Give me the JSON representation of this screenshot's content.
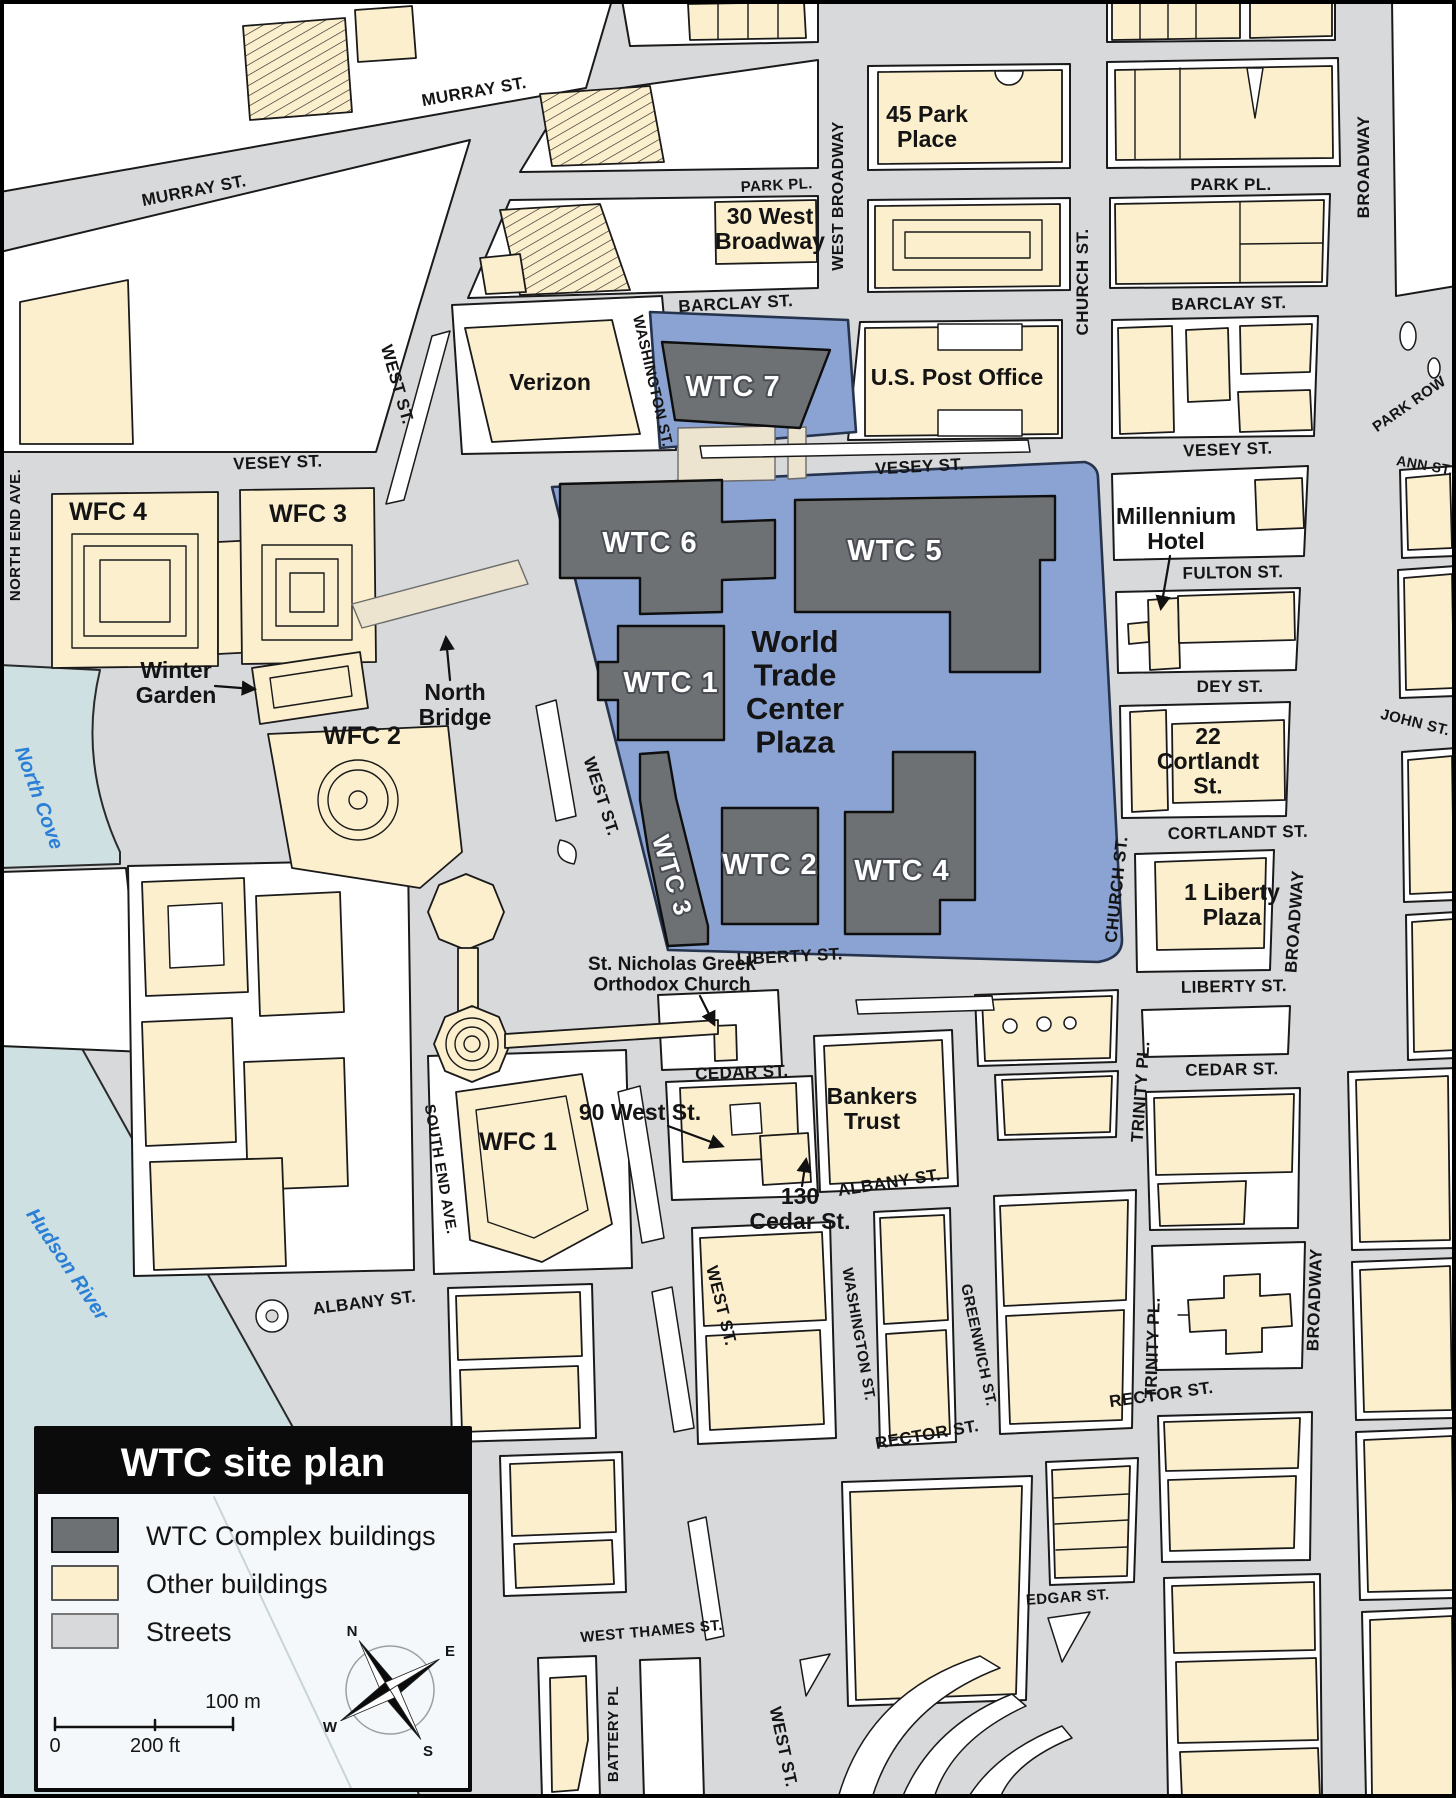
{
  "page_title": "WTC site plan",
  "colors": {
    "wtc": "#6e7173",
    "other": "#fcefcd",
    "street": "#d8d9db",
    "plaza": "#8ba3d2",
    "water": "#cfe0e3",
    "outline": "#1a1a1a"
  },
  "legend": {
    "title": "WTC site plan",
    "items": [
      {
        "label": "WTC Complex buildings",
        "color_key": "wtc"
      },
      {
        "label": "Other buildings",
        "color_key": "other"
      },
      {
        "label": "Streets",
        "color_key": "street"
      }
    ]
  },
  "scale_bar": {
    "m_label": "100 m",
    "zero_label": "0",
    "ft_label": "200 ft"
  },
  "compass": {
    "n": "N",
    "e": "E",
    "s": "S",
    "w": "W"
  },
  "water_labels": [
    {
      "text": "North Cove",
      "x": 33,
      "y": 800,
      "rot": 70,
      "cls": "wat",
      "name": "north-cove-label"
    },
    {
      "text": "Hudson River",
      "x": 62,
      "y": 1268,
      "rot": 56,
      "cls": "wat",
      "name": "hudson-river-label"
    }
  ],
  "street_labels": [
    {
      "text": "MURRAY ST.",
      "x": 475,
      "y": 97,
      "rot": -10
    },
    {
      "text": "MURRAY ST.",
      "x": 195,
      "y": 196,
      "rot": -11
    },
    {
      "text": "PARK PL.",
      "x": 777,
      "y": 190,
      "rot": -3,
      "size": 15
    },
    {
      "text": "PARK PL.",
      "x": 1231,
      "y": 190,
      "rot": 0
    },
    {
      "text": "BARCLAY ST.",
      "x": 736,
      "y": 309,
      "rot": -3
    },
    {
      "text": "BARCLAY ST.",
      "x": 1229,
      "y": 309,
      "rot": -1
    },
    {
      "text": "WEST BROADWAY",
      "x": 843,
      "y": 196,
      "rot": -90,
      "size": 16
    },
    {
      "text": "CHURCH ST.",
      "x": 1088,
      "y": 282,
      "rot": -90
    },
    {
      "text": "BROADWAY",
      "x": 1369,
      "y": 167,
      "rot": -90
    },
    {
      "text": "PARK ROW",
      "x": 1412,
      "y": 408,
      "rot": -35,
      "size": 15
    },
    {
      "text": "ANN ST.",
      "x": 1424,
      "y": 470,
      "rot": 10,
      "size": 14
    },
    {
      "text": "VESEY ST.",
      "x": 278,
      "y": 468,
      "rot": -2
    },
    {
      "text": "VESEY ST.",
      "x": 920,
      "y": 472,
      "rot": -3
    },
    {
      "text": "VESEY ST.",
      "x": 1228,
      "y": 455,
      "rot": -2
    },
    {
      "text": "WASHINGTON ST.",
      "x": 648,
      "y": 382,
      "rot": 77,
      "size": 15
    },
    {
      "text": "FULTON ST.",
      "x": 1233,
      "y": 578,
      "rot": -1
    },
    {
      "text": "DEY ST.",
      "x": 1230,
      "y": 692,
      "rot": 0
    },
    {
      "text": "JOHN ST.",
      "x": 1414,
      "y": 727,
      "rot": 14,
      "size": 15
    },
    {
      "text": "CORTLANDT ST.",
      "x": 1238,
      "y": 838,
      "rot": -1
    },
    {
      "text": "LIBERTY ST.",
      "x": 790,
      "y": 962,
      "rot": -3
    },
    {
      "text": "LIBERTY ST.",
      "x": 1234,
      "y": 992,
      "rot": -1
    },
    {
      "text": "CEDAR ST.",
      "x": 742,
      "y": 1078,
      "rot": -2
    },
    {
      "text": "CEDAR ST.",
      "x": 1232,
      "y": 1075,
      "rot": -1
    },
    {
      "text": "TRINITY PL.",
      "x": 1146,
      "y": 1092,
      "rot": -86
    },
    {
      "text": "TRINITY PL.",
      "x": 1158,
      "y": 1348,
      "rot": -88
    },
    {
      "text": "CHURCH ST.",
      "x": 1122,
      "y": 890,
      "rot": -84
    },
    {
      "text": "BROADWAY",
      "x": 1300,
      "y": 922,
      "rot": -86
    },
    {
      "text": "BROADWAY",
      "x": 1320,
      "y": 1300,
      "rot": -88
    },
    {
      "text": "ALBANY ST.",
      "x": 365,
      "y": 1308,
      "rot": -7
    },
    {
      "text": "ALBANY ST.",
      "x": 890,
      "y": 1188,
      "rot": -9
    },
    {
      "text": "WASHINGTON ST.",
      "x": 854,
      "y": 1335,
      "rot": 80,
      "size": 15
    },
    {
      "text": "GREENWICH ST.",
      "x": 974,
      "y": 1346,
      "rot": 78,
      "size": 15
    },
    {
      "text": "RECTOR ST.",
      "x": 928,
      "y": 1440,
      "rot": -10
    },
    {
      "text": "RECTOR ST.",
      "x": 1162,
      "y": 1400,
      "rot": -8
    },
    {
      "text": "EDGAR ST.",
      "x": 1068,
      "y": 1602,
      "rot": -4,
      "size": 15
    },
    {
      "text": "WEST THAMES ST.",
      "x": 652,
      "y": 1636,
      "rot": -5,
      "size": 15
    },
    {
      "text": "BATTERY PL",
      "x": 618,
      "y": 1734,
      "rot": -90,
      "size": 15
    },
    {
      "text": "WEST ST.",
      "x": 392,
      "y": 386,
      "rot": 74
    },
    {
      "text": "WEST ST.",
      "x": 596,
      "y": 798,
      "rot": 72
    },
    {
      "text": "WEST ST.",
      "x": 716,
      "y": 1307,
      "rot": 76
    },
    {
      "text": "WEST ST.",
      "x": 778,
      "y": 1748,
      "rot": 78
    },
    {
      "text": "NORTH END AVE.",
      "x": 20,
      "y": 535,
      "rot": -90,
      "size": 15
    },
    {
      "text": "SOUTH END AVE.",
      "x": 436,
      "y": 1170,
      "rot": 80,
      "size": 15
    }
  ],
  "building_labels": [
    {
      "text": "Verizon",
      "x": 550,
      "y": 390
    },
    {
      "text": "U.S. Post Office",
      "x": 957,
      "y": 385
    },
    {
      "text": "45 Park\nPlace",
      "x": 927,
      "y": 122
    },
    {
      "text": "30 West\nBroadway",
      "x": 770,
      "y": 224
    },
    {
      "text": "WFC 4",
      "x": 108,
      "y": 520,
      "size": 25
    },
    {
      "text": "WFC 3",
      "x": 308,
      "y": 522,
      "size": 25
    },
    {
      "text": "Winter\nGarden",
      "x": 176,
      "y": 678
    },
    {
      "text": "North\nBridge",
      "x": 455,
      "y": 700
    },
    {
      "text": "WFC 2",
      "x": 362,
      "y": 744,
      "size": 25
    },
    {
      "text": "WFC 1",
      "x": 518,
      "y": 1150,
      "size": 25
    },
    {
      "text": "Millennium\nHotel",
      "x": 1176,
      "y": 524
    },
    {
      "text": "22\nCortlandt\nSt.",
      "x": 1208,
      "y": 744
    },
    {
      "text": "1 Liberty\nPlaza",
      "x": 1232,
      "y": 900
    },
    {
      "text": "St. Nicholas Greek\nOrthodox Church",
      "x": 672,
      "y": 970,
      "size": 19
    },
    {
      "text": "Bankers\nTrust",
      "x": 872,
      "y": 1104
    },
    {
      "text": "90 West St.",
      "x": 640,
      "y": 1120
    },
    {
      "text": "130\nCedar St.",
      "x": 800,
      "y": 1204
    }
  ],
  "wtc_labels": [
    {
      "text": "WTC 7",
      "x": 733,
      "y": 396
    },
    {
      "text": "WTC 6",
      "x": 650,
      "y": 552
    },
    {
      "text": "WTC 5",
      "x": 895,
      "y": 560
    },
    {
      "text": "WTC 1",
      "x": 671,
      "y": 692
    },
    {
      "text": "WTC 2",
      "x": 770,
      "y": 874
    },
    {
      "text": "WTC 4",
      "x": 902,
      "y": 880
    },
    {
      "text": "WTC 3",
      "x": 664,
      "y": 878,
      "rot": 73,
      "size": 25
    }
  ],
  "plaza_label": [
    {
      "text": "World\nTrade\nCenter\nPlaza",
      "x": 795,
      "y": 652,
      "cls": "plz",
      "name": "wtc-plaza-label"
    }
  ]
}
